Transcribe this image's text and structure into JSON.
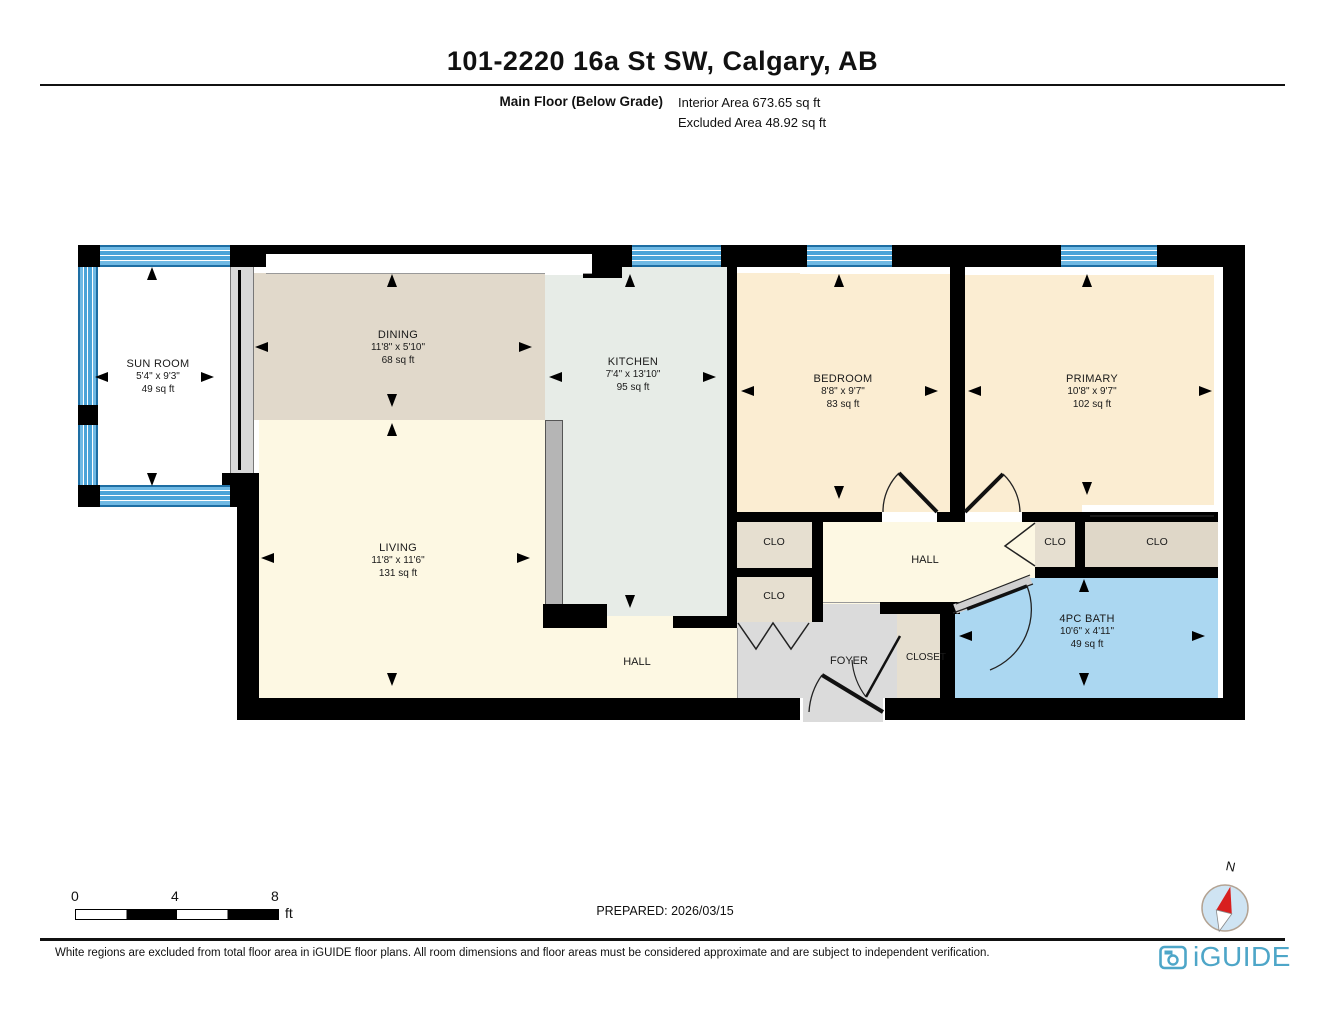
{
  "header": {
    "title": "101-2220 16a St SW, Calgary, AB"
  },
  "floor_info": {
    "floor_label": "Main Floor (Below Grade)",
    "interior_area": "Interior Area 673.65 sq ft",
    "excluded_area": "Excluded Area 48.92 sq ft"
  },
  "rooms": [
    {
      "id": "sunroom",
      "name": "SUN ROOM",
      "dims": "5'4\" x 9'3\"",
      "area": "49 sq ft"
    },
    {
      "id": "dining",
      "name": "DINING",
      "dims": "11'8\" x 5'10\"",
      "area": "68 sq ft"
    },
    {
      "id": "kitchen",
      "name": "KITCHEN",
      "dims": "7'4\" x 13'10\"",
      "area": "95 sq ft"
    },
    {
      "id": "living",
      "name": "LIVING",
      "dims": "11'8\" x 11'6\"",
      "area": "131 sq ft"
    },
    {
      "id": "bedroom",
      "name": "BEDROOM",
      "dims": "8'8\" x 9'7\"",
      "area": "83 sq ft"
    },
    {
      "id": "primary",
      "name": "PRIMARY",
      "dims": "10'8\" x 9'7\"",
      "area": "102 sq ft"
    },
    {
      "id": "bath",
      "name": "4PC BATH",
      "dims": "10'6\" x 4'11\"",
      "area": "49 sq ft"
    }
  ],
  "labels": {
    "clo": "CLO",
    "hall": "HALL",
    "foyer": "FOYER",
    "closet": "CLOSET"
  },
  "scale_bar": {
    "tick0": "0",
    "tick4": "4",
    "tick8": "8",
    "unit": "ft"
  },
  "prepared": "PREPARED: 2026/03/15",
  "compass": {
    "north_label": "N"
  },
  "footer": {
    "disclaimer": "White regions are excluded from total floor area in iGUIDE floor plans. All room dimensions and floor areas must be considered approximate and are subject to independent verification.",
    "brand": "iGUIDE"
  },
  "colors": {
    "wall": "#000000",
    "window_blue": "#4AA3D8",
    "bath_blue": "#ABD7F1",
    "dining_tan": "#E1D9CB",
    "kitchen_green": "#E7ECE7",
    "cream": "#FDF8E3",
    "bedroom_cream": "#FBEDD2",
    "closet_tan": "#E6DFD0",
    "foyer_gray": "#DBDBDB",
    "brand_blue": "#4EA6C8"
  }
}
